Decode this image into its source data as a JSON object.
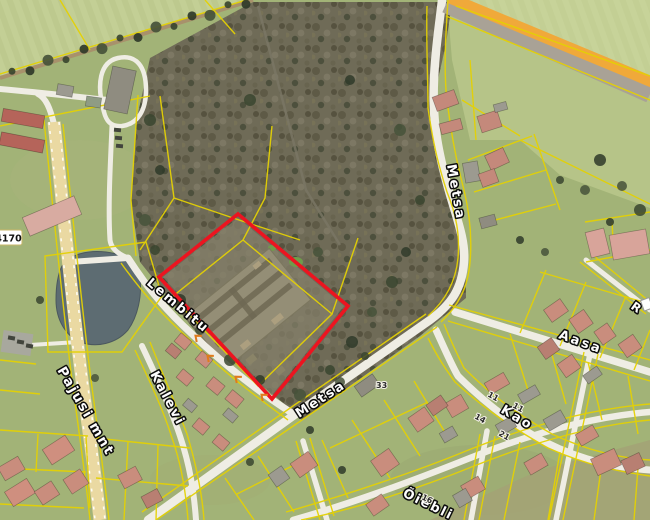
{
  "map": {
    "type": "aerial-cadastral-map",
    "streets": {
      "lembitu": "Lembitu",
      "kalevi": "Kalevi",
      "metsa_north": "Metsa",
      "metsa_south": "Metsa",
      "aasa": "Aasa",
      "kao": "Kao",
      "pajusi_mnt": "Pajusi mnt",
      "oiebliku": "Õiebli",
      "partial_right": "R"
    },
    "road_number_badge": "4170",
    "house_numbers": [
      "33",
      "11",
      "11",
      "14",
      "21",
      "16"
    ],
    "colors": {
      "parcel_line": "#e4d104",
      "selected_plot_outline": "#ec1420",
      "main_road_fill": "#ead9a2",
      "highway_fill": "#f0a93a",
      "water": "#5d6c72",
      "forest": "#6f6b57",
      "field": "#bdc98e",
      "access_mark": "#e07b1c"
    }
  }
}
